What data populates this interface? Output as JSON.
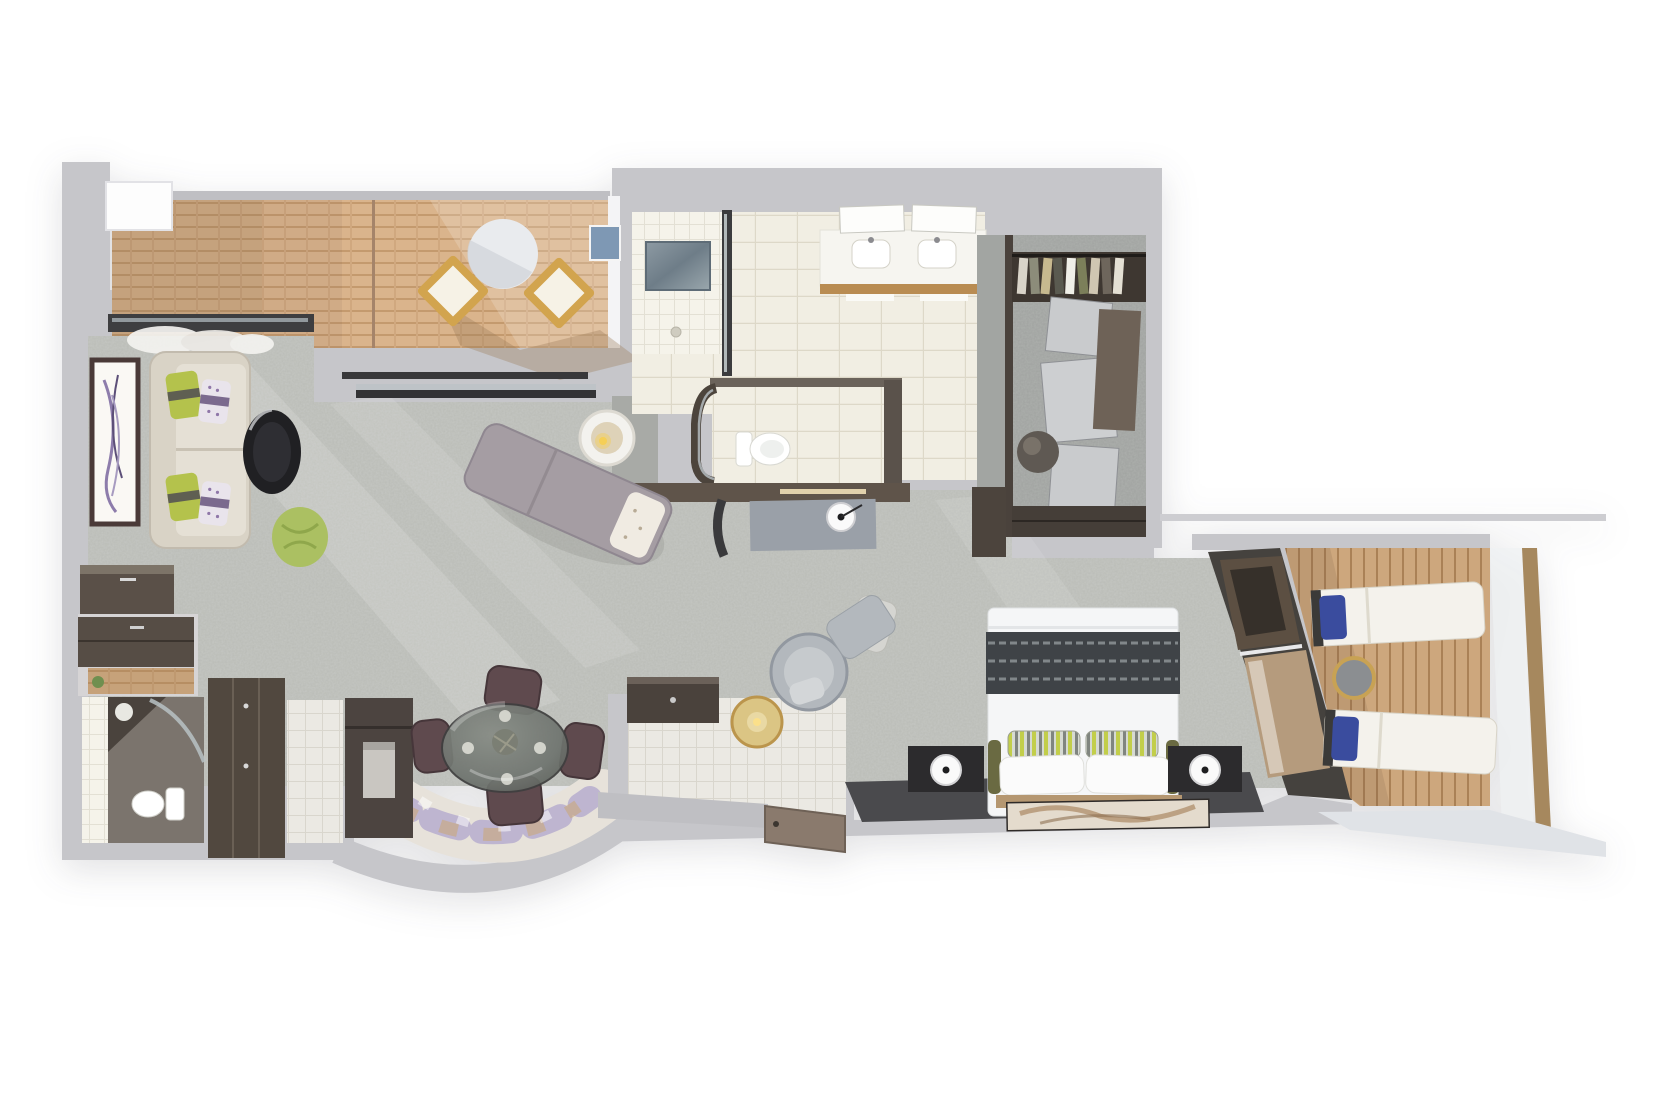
{
  "scene": {
    "type": "floor-plan-3d-render",
    "subject": "Top-down 3D rendering of a suite floor plan with two balconies",
    "background_color": "#ffffff",
    "has_text": false
  },
  "palette": {
    "wall": "#c6c6ca",
    "wall_dark_wood": "#574e46",
    "carpet": "#b9bbb6",
    "deck_front_wood": "#d9b48c",
    "deck_side_wood": "#c9a379",
    "bathroom_tile": "#f0ede2",
    "white_tile": "#ebe9e3",
    "closet_marble": "#a2a5a2",
    "charcoal_rug": "#4a4a4d",
    "sofa_cream": "#d9d3c6",
    "pillow_green": "#b4c24c",
    "pillow_purple": "#cbb8d8",
    "coffee_table_black": "#202023",
    "pouf_green": "#abc062",
    "chaise_mauve": "#a59da3",
    "dining_chair_plum": "#5f4a4e",
    "glass_table": "#6f746f",
    "rug_purple": "#9c8fc9",
    "rug_tan": "#c9a87b",
    "bed_white": "#f5f6f7",
    "bed_runner_dark": "#3f4347",
    "accent_stripe_green": "#c2ce4a",
    "bolster_olive": "#6a6a42",
    "nightstand_black": "#2c2b2d",
    "headboard_wood": "#b59771",
    "lounger_white": "#f4f2ec",
    "lounger_pillow_blue": "#3a4c9e",
    "gold_accent": "#c8a254",
    "lower_deck": "#e0e3e7",
    "blue_artwork": "#7e98b4",
    "entry_door_brown": "#8a7a6d",
    "guest_wc_floor": "#7b746d"
  },
  "rooms": [
    {
      "id": "front-balcony",
      "label": "front balcony",
      "floor": "horizontal wood deck",
      "furniture": [
        "round white table",
        "two wood deck chairs",
        "railing"
      ]
    },
    {
      "id": "living-room",
      "label": "living room",
      "floor": "gray mottled carpet",
      "furniture": [
        "cream sofa with green and purple pillows",
        "framed botanical artwork",
        "black round coffee table",
        "green pouf",
        "chaise lounge with pillow",
        "round side table with candle",
        "dark sideboard"
      ]
    },
    {
      "id": "dining-area",
      "label": "dining area",
      "floor": "carpet with curved abstract rug",
      "furniture": [
        "round glass dining table with place settings",
        "four plum dining chairs",
        "dark wall cabinet with niche"
      ]
    },
    {
      "id": "bathroom",
      "label": "main bathroom",
      "floor": "cream tile",
      "furniture": [
        "walk-in shower with marble bench and glass screen",
        "double vanity with two sinks and mirror panels",
        "blue artwork"
      ]
    },
    {
      "id": "water-closet",
      "label": "toilet room",
      "floor": "cream tile",
      "furniture": [
        "toilet",
        "curved glass door"
      ]
    },
    {
      "id": "walk-in-closet",
      "label": "walk-in closet",
      "floor": "gray marble",
      "furniture": [
        "wardrobe with hanging clothes",
        "stacked cabinet units",
        "round dark pouf",
        "low dresser"
      ]
    },
    {
      "id": "dressing-corridor",
      "label": "dressing corridor",
      "floor": "gray carpet",
      "furniture": [
        "vanity desk with round lamp",
        "vanity chair"
      ]
    },
    {
      "id": "bedroom",
      "label": "bedroom",
      "floor": "gray mottled carpet",
      "furniture": [
        "king bed with striped runner and striped accent pillows",
        "two black nightstands with round white lamps",
        "charcoal runner rug",
        "tan art rug",
        "swivel chair",
        "ottoman",
        "gold candle table",
        "angled window wall with TV panel"
      ]
    },
    {
      "id": "side-balcony",
      "label": "side balcony",
      "floor": "vertical wood deck",
      "furniture": [
        "two white sun loungers with blue pillows",
        "round gold-rim side table",
        "wood railing",
        "lower deck ledge"
      ]
    },
    {
      "id": "entry-foyer",
      "label": "entry foyer",
      "floor": "white tile",
      "furniture": [
        "dark console cabinet",
        "entrance door panel"
      ]
    },
    {
      "id": "guest-toilet",
      "label": "guest toilet",
      "floor": "dark stone",
      "furniture": [
        "toilet",
        "corner vanity",
        "glass door"
      ]
    },
    {
      "id": "desk-nook",
      "label": "desk nook",
      "furniture": [
        "dark wall cabinet",
        "wood desk shelf",
        "small plant"
      ]
    },
    {
      "id": "entry-closet",
      "label": "entry closet",
      "furniture": [
        "tall dark wardrobe",
        "white tile floor strip"
      ]
    }
  ]
}
